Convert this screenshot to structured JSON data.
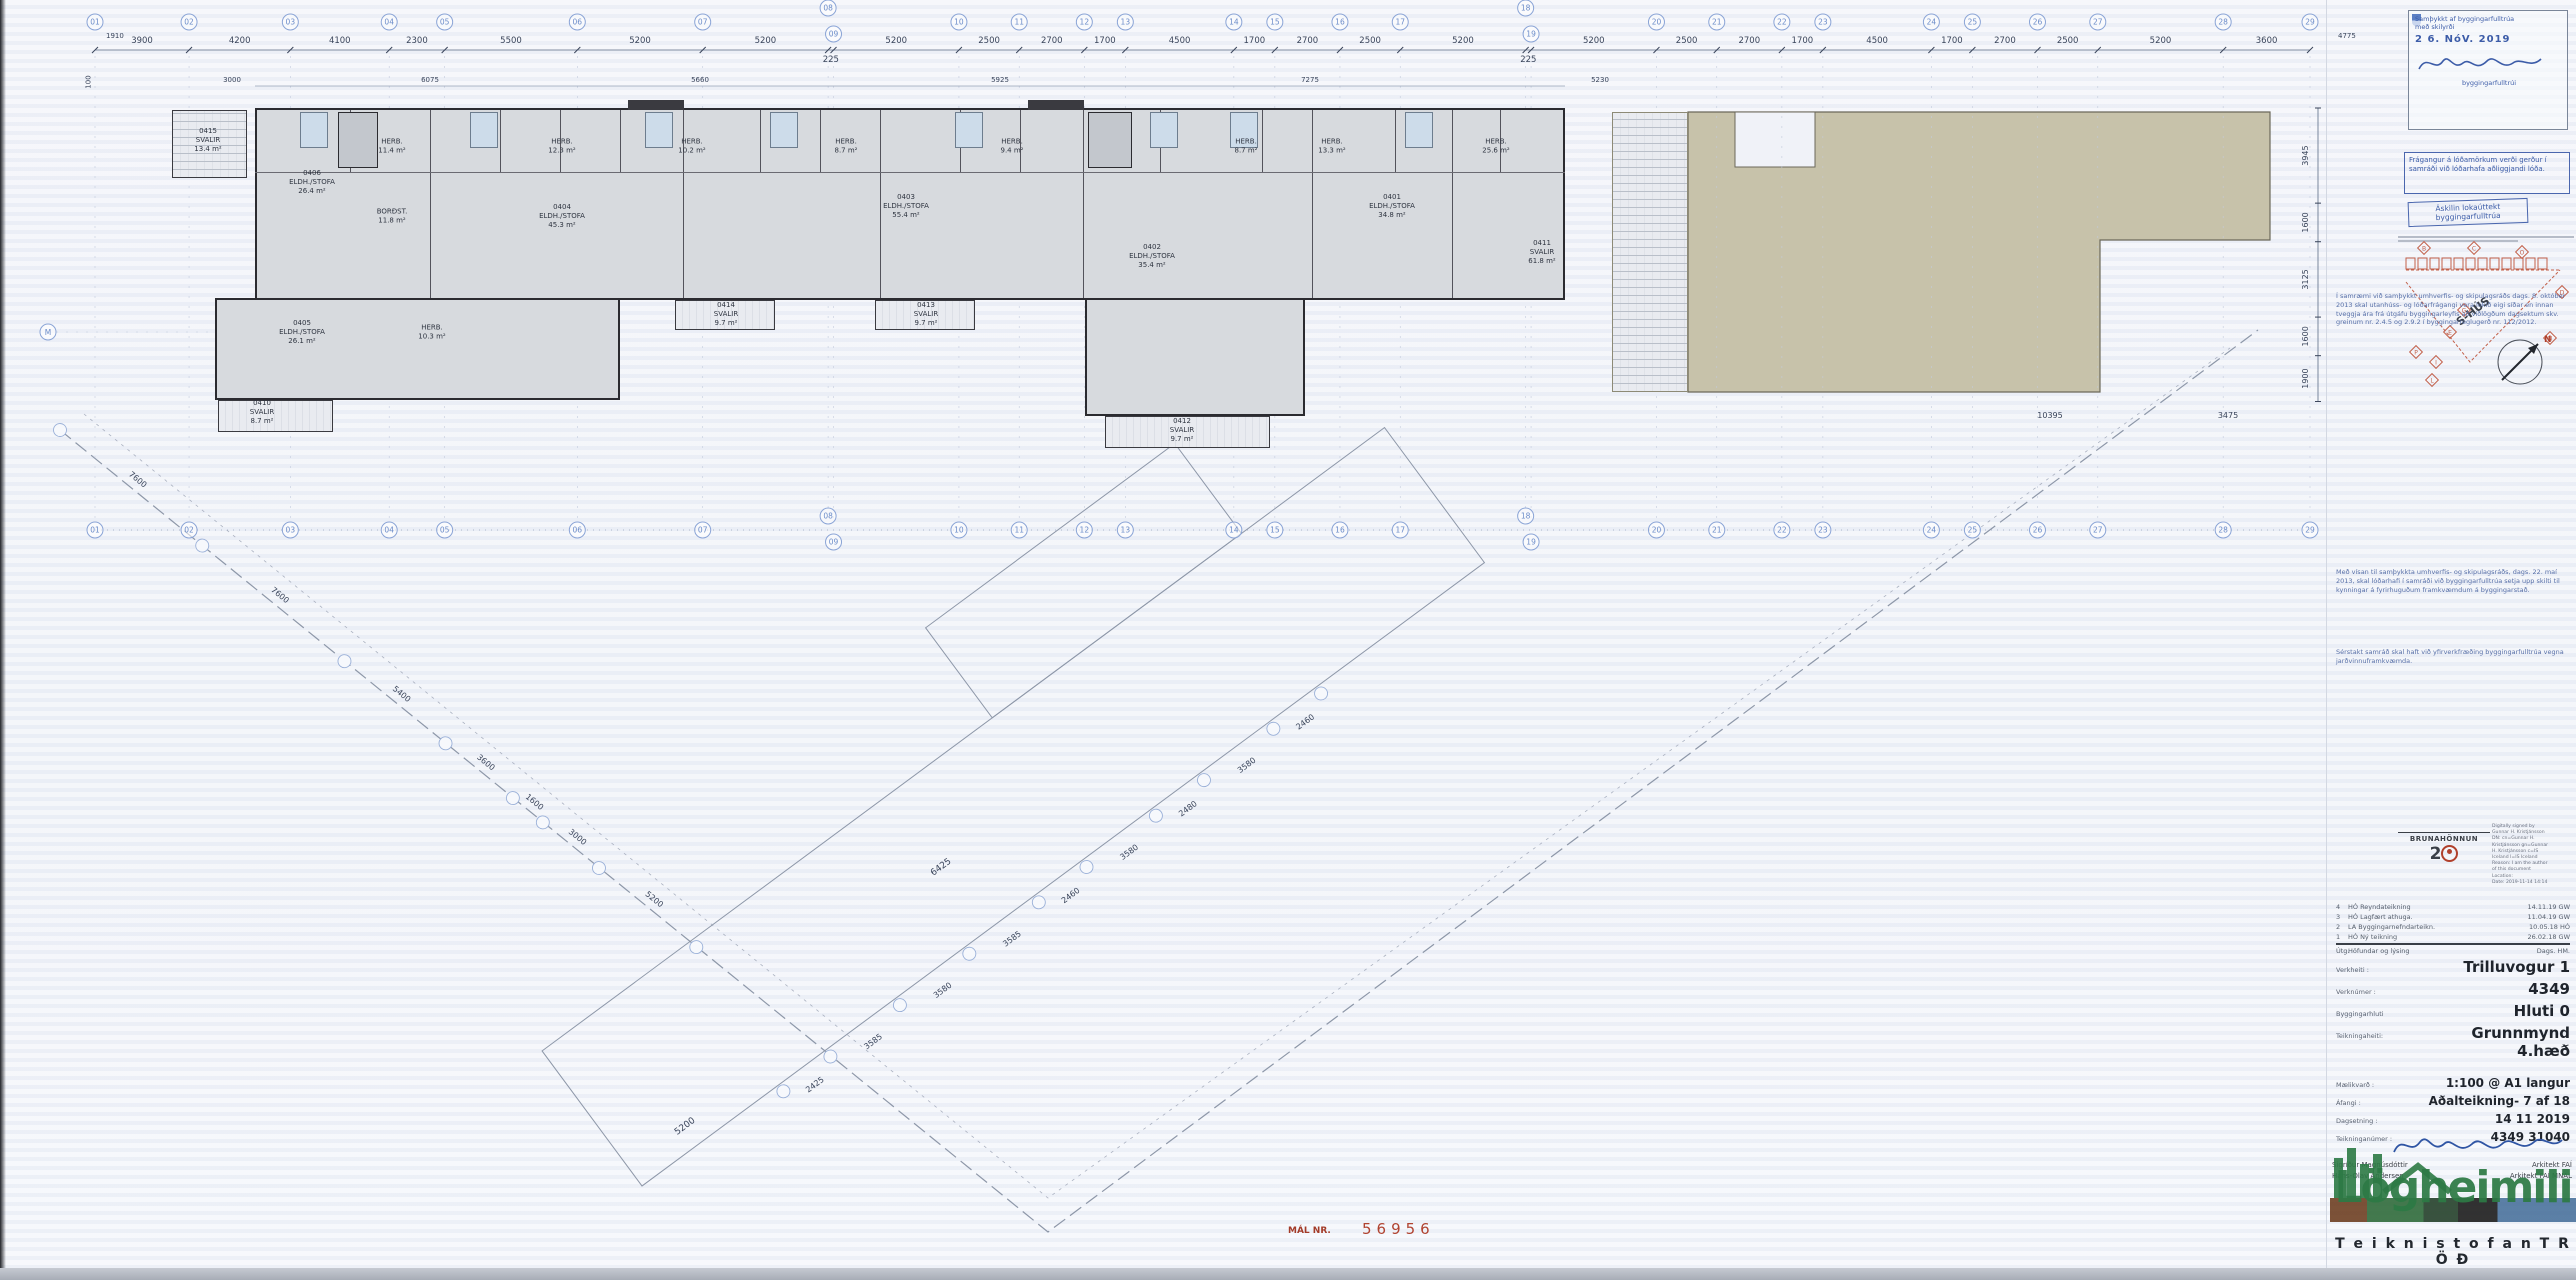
{
  "sheet": {
    "mal_label": "MÁL NR.",
    "mal_value": "56956"
  },
  "grid_top": {
    "labels": [
      "01",
      "02",
      "03",
      "04",
      "05",
      "06",
      "07",
      "08",
      "09",
      "10",
      "11",
      "12",
      "13",
      "14",
      "15",
      "16",
      "17",
      "18",
      "19",
      "20",
      "21",
      "22",
      "23",
      "24",
      "25",
      "26",
      "27",
      "28",
      "29"
    ],
    "dims": [
      3900,
      4200,
      4100,
      2300,
      5500,
      5200,
      5200,
      225,
      5200,
      2500,
      2700,
      1700,
      4500,
      1700,
      2700,
      2500,
      5200,
      225,
      5200,
      2500,
      2700,
      1700,
      4500,
      1700,
      2700,
      2500,
      5200,
      3600
    ]
  },
  "corner_dims": {
    "left_top": "1910",
    "left_side": "100",
    "right_top": "4775"
  },
  "sub_dims": [
    {
      "v": "3000",
      "x": 232
    },
    {
      "v": "6075",
      "x": 430
    },
    {
      "v": "5660",
      "x": 700
    },
    {
      "v": "5925",
      "x": 1000
    },
    {
      "v": "7275",
      "x": 1310
    },
    {
      "v": "5230",
      "x": 1600
    }
  ],
  "right_dims": [
    "3945",
    "1600",
    "3125",
    "1600",
    "1900"
  ],
  "roof_dims": [
    {
      "v": "10395",
      "x": 2050,
      "y": 418
    },
    {
      "v": "3475",
      "x": 2228,
      "y": 418
    }
  ],
  "left_bubble": "M",
  "rooms": [
    {
      "no": "0415",
      "name": "SVALIR",
      "area": "13.4 m²",
      "x": 208,
      "y": 140
    },
    {
      "no": "0406",
      "name": "ELDH./STOFA",
      "area": "26.4 m²",
      "x": 312,
      "y": 182
    },
    {
      "no": "",
      "name": "HERB.",
      "area": "11.4 m²",
      "x": 392,
      "y": 146
    },
    {
      "no": "",
      "name": "BORÐST.",
      "area": "11.8 m²",
      "x": 392,
      "y": 216
    },
    {
      "no": "0405",
      "name": "ELDH./STOFA",
      "area": "26.1 m²",
      "x": 302,
      "y": 332
    },
    {
      "no": "",
      "name": "HERB.",
      "area": "10.3 m²",
      "x": 432,
      "y": 332
    },
    {
      "no": "0410",
      "name": "SVALIR",
      "area": "8.7 m²",
      "x": 262,
      "y": 412
    },
    {
      "no": "",
      "name": "HERB.",
      "area": "12.3 m²",
      "x": 562,
      "y": 146
    },
    {
      "no": "0404",
      "name": "ELDH./STOFA",
      "area": "45.3 m²",
      "x": 562,
      "y": 216
    },
    {
      "no": "0414",
      "name": "SVALIR",
      "area": "9.7 m²",
      "x": 726,
      "y": 314
    },
    {
      "no": "",
      "name": "HERB.",
      "area": "10.2 m²",
      "x": 692,
      "y": 146
    },
    {
      "no": "0403",
      "name": "ELDH./STOFA",
      "area": "55.4 m²",
      "x": 906,
      "y": 206
    },
    {
      "no": "",
      "name": "HERB.",
      "area": "8.7 m²",
      "x": 846,
      "y": 146
    },
    {
      "no": "0413",
      "name": "SVALIR",
      "area": "9.7 m²",
      "x": 926,
      "y": 314
    },
    {
      "no": "",
      "name": "HERB.",
      "area": "9.4 m²",
      "x": 1012,
      "y": 146
    },
    {
      "no": "0402",
      "name": "ELDH./STOFA",
      "area": "35.4 m²",
      "x": 1152,
      "y": 256
    },
    {
      "no": "",
      "name": "HERB.",
      "area": "8.7 m²",
      "x": 1246,
      "y": 146
    },
    {
      "no": "0412",
      "name": "SVALIR",
      "area": "9.7 m²",
      "x": 1182,
      "y": 430
    },
    {
      "no": "",
      "name": "HERB.",
      "area": "13.3 m²",
      "x": 1332,
      "y": 146
    },
    {
      "no": "0401",
      "name": "ELDH./STOFA",
      "area": "34.8 m²",
      "x": 1392,
      "y": 206
    },
    {
      "no": "",
      "name": "HERB.",
      "area": "25.6 m²",
      "x": 1496,
      "y": 146
    },
    {
      "no": "0411",
      "name": "SVALIR",
      "area": "61.8 m²",
      "x": 1542,
      "y": 252
    }
  ],
  "site": {
    "left_chain": [
      "7600",
      "7600",
      "5400",
      "3600",
      "1600",
      "3000",
      "5200"
    ],
    "right_chain": [
      "2425",
      "3585",
      "3580",
      "3585",
      "2460",
      "3580",
      "2480",
      "3580",
      "2460"
    ],
    "inner_a": "6425",
    "inner_b": "5200"
  },
  "stamp": {
    "line1": "Samþykkt af byggingarfulltrúa",
    "line2": "með skilyrði",
    "date": "2 6. NóV. 2019",
    "sig_title": "byggingarfulltrúi"
  },
  "condition_box": "Frágangur á lóðamörkum verði gerður í samráði við lóðarhafa aðliggjandi lóða.",
  "inspection_stamp": "Áskilin lokaúttekt byggingarfulltrúa",
  "keyplan": {
    "label": "S-HÚS",
    "north": "N",
    "diamonds": [
      "B",
      "C",
      "O",
      "D",
      "N",
      "P",
      "I",
      "L",
      "G",
      "E"
    ]
  },
  "notes": [
    "Í samræmi við samþykkt umhverfis- og skipulagsráðs dags. 8. október 2013 skal utanhúss- og lóðarfrágangi vera lokið eigi síðar en innan tveggja ára frá útgáfu byggingarleyfis að viðlögðum dagsektum skv. greinum nr. 2.4.5 og 2.9.2 í byggingarreglugerð nr. 112/2012.",
    "Með vísan til samþykkta umhverfis- og skipulagsráðs, dags. 22. maí 2013, skal lóðarhafi í samráði við byggingarfulltrúa setja upp skilti til kynningar á fyrirhuguðum framkvæmdum á byggingarstað.",
    "Sérstakt samráð skal haft við yfirverkfræðing byggingarfulltrúa vegna jarðvinnuframkvæmda."
  ],
  "digsig": [
    "Digitally signed by",
    "Gunnar H. Kristjánsson",
    "DN: cn=Gunnar H.",
    "Kristjánsson gn=Gunnar",
    "H. Kristjánsson c=IS",
    "Iceland l=IS Iceland",
    "Reason: I am the author",
    "of this document",
    "Location:",
    "Date: 2019-11-14 14:14"
  ],
  "brand": {
    "name": "BRUNAHÖNNUN",
    "num": "2"
  },
  "revisions": {
    "rows": [
      {
        "n": "4",
        "d": "HÓ Reyndateikning",
        "t": "14.11.19  GW"
      },
      {
        "n": "3",
        "d": "HÓ Lagfært athuga.",
        "t": "11.04.19  GW"
      },
      {
        "n": "2",
        "d": "LA Byggingarnefndarteikn.",
        "t": "10.05.18  HÓ"
      },
      {
        "n": "1",
        "d": "HÓ Ný teikning",
        "t": "26.02.18  GW"
      }
    ],
    "foot_n": "Útg.",
    "foot_d": "Höfundar og lýsing",
    "foot_t": "Dags.    HM."
  },
  "titleblock": {
    "rows": [
      {
        "label": "Verkheiti :",
        "value": "Trilluvogur 1",
        "big": true
      },
      {
        "label": "Verknúmer :",
        "value": "4349",
        "big": true
      },
      {
        "label": "Byggingarhluti",
        "value": "Hluti 0",
        "big": true
      },
      {
        "label": "Teikningaheiti:",
        "value": "Grunnmynd 4.hæð",
        "big": true,
        "gap": true
      },
      {
        "label": "Mælikvarð :",
        "value": "1:100 @ A1 langur"
      },
      {
        "label": "Áfangi :",
        "value": "Aðalteikning-  7 af 18"
      },
      {
        "label": "Dagsetning :",
        "value": "14 11 2019"
      },
      {
        "label": "Teikninganúmer :",
        "value": "4349 31040"
      }
    ]
  },
  "credits": {
    "left_name": "Sigríður Magnúsdóttir",
    "left_title": "Arkitekt FAÍ",
    "right_name": "Hans-Olav Andersen",
    "right_title": "Arkitekt FAÍ MNAL"
  },
  "logo": {
    "word": "Lögheimili",
    "sub": "T e i k n i s t o f a n   T R Ö Ð"
  }
}
